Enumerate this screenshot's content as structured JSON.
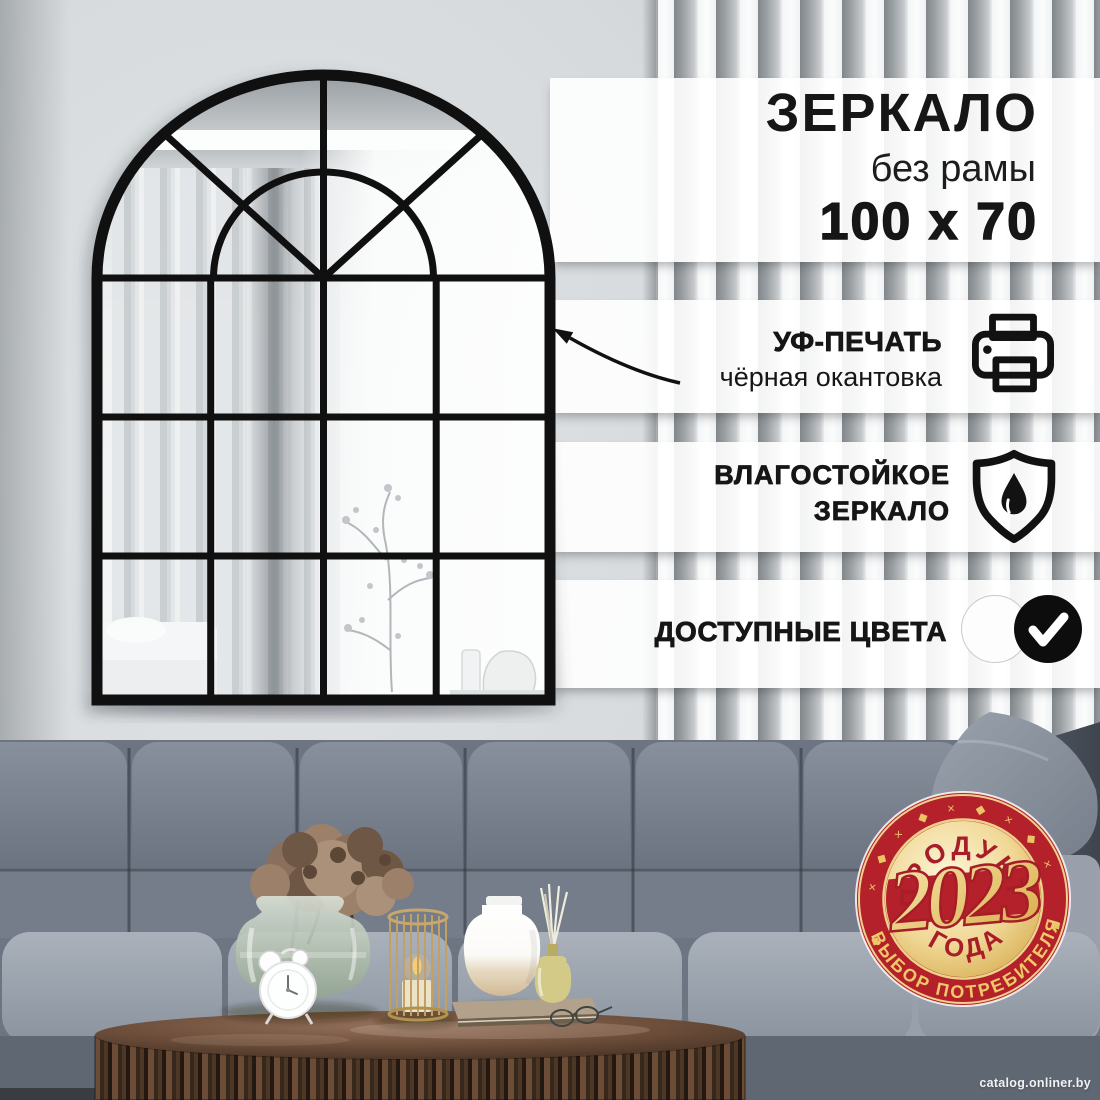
{
  "product": {
    "title": "ЗЕРКАЛО",
    "subtitle": "без рамы",
    "size": "100 x 70"
  },
  "features": [
    {
      "title": "УФ-ПЕЧАТЬ",
      "subtitle": "чёрная окантовка",
      "icon": "printer-icon"
    },
    {
      "line1": "ВЛАГОСТОЙКОЕ",
      "line2": "ЗЕРКАЛО",
      "icon": "shield-drop-icon"
    },
    {
      "title": "ДОСТУПНЫЕ ЦВЕТА",
      "icon": "color-swatches"
    }
  ],
  "swatches": [
    {
      "name": "white",
      "checked": false
    },
    {
      "name": "black",
      "checked": true,
      "icon": "check-icon"
    }
  ],
  "badge": {
    "top": "ПРОДУКТ",
    "year": "2023",
    "bottom": "ГОДА",
    "ribbon": "ВЫБОР ПОТРЕБИТЕЛЯ",
    "ornament": "◆ × ◆ × ◆ × ◆ × ◆ × ◆",
    "ornament_diamond": "◆"
  },
  "watermark": "catalog.onliner.by",
  "colors": {
    "badge_red": "#b5212b",
    "badge_gold": "#e8c25c",
    "frame_black": "#111111",
    "text": "#151515"
  }
}
